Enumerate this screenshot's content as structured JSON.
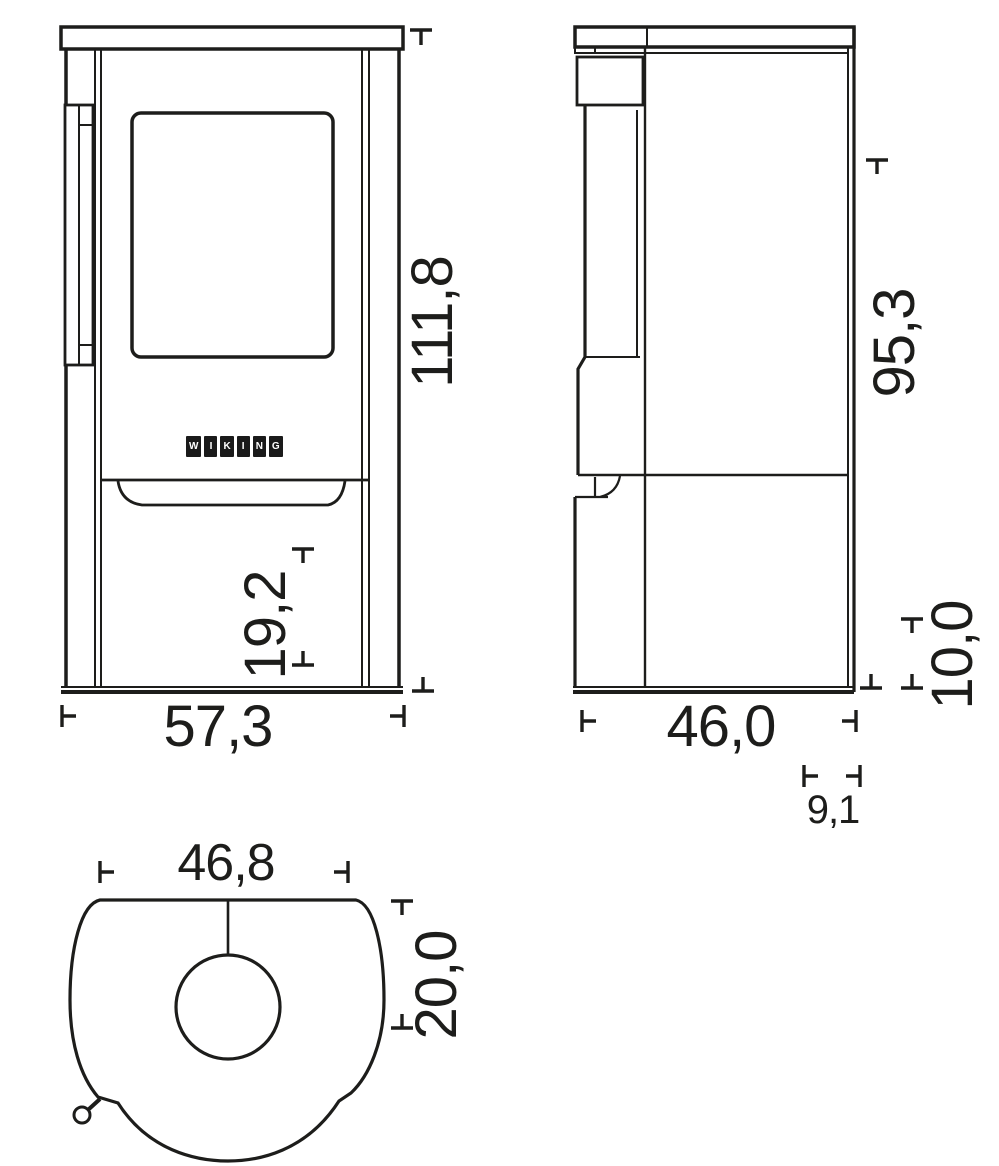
{
  "drawing": {
    "title": "stove-dimension-drawing",
    "colors": {
      "line": "#1d1d1b",
      "background": "#ffffff",
      "logo_block": "#1a1a1a",
      "logo_text": "#ffffff"
    },
    "logo": {
      "word": "WIKING",
      "letters": [
        "W",
        "I",
        "K",
        "I",
        "N",
        "G"
      ]
    },
    "dimensions": {
      "front_height": "111,8",
      "front_width": "57,3",
      "front_lower_height": "19,2",
      "side_upper_height": "95,3",
      "side_depth": "46,0",
      "side_base_height": "10,0",
      "side_back_offset": "9,1",
      "top_width": "46,8",
      "top_flue_offset": "20,0"
    }
  }
}
